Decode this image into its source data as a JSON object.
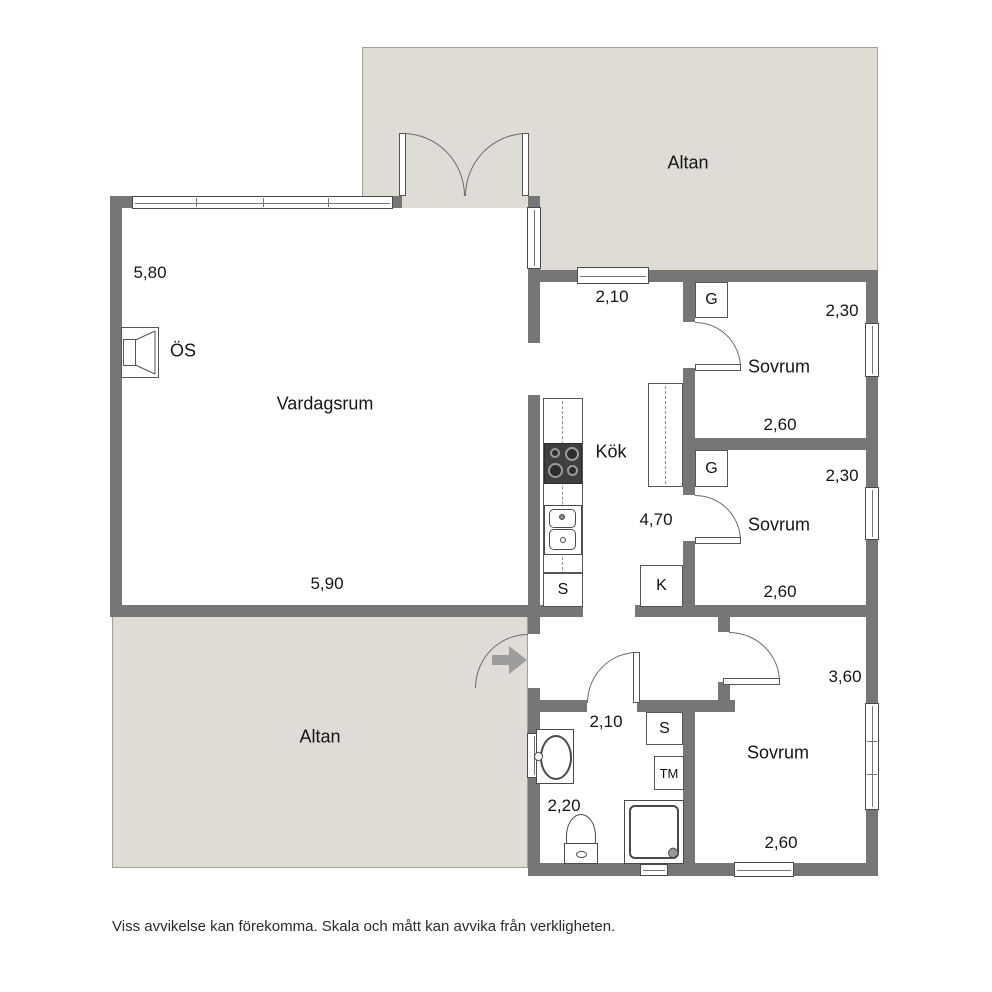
{
  "meta": {
    "type": "floor-plan"
  },
  "colors": {
    "wall": "#767676",
    "terrace_fill": "#dfdcd5",
    "fixture_line": "#4a4a4a",
    "entry_arrow": "#9c9c9c"
  },
  "rooms": {
    "altan_top": {
      "label": "Altan"
    },
    "altan_bottom": {
      "label": "Altan"
    },
    "vardagsrum": {
      "label": "Vardagsrum",
      "dim_height": "5,80",
      "dim_width": "5,90",
      "fireplace": "ÖS"
    },
    "kok": {
      "label": "Kök",
      "window_dim": "2,10",
      "dim_length": "4,70",
      "cabinet": "S",
      "fridge": "K"
    },
    "sovrum1": {
      "label": "Sovrum",
      "dim_height": "2,30",
      "dim_width": "2,60",
      "wardrobe": "G"
    },
    "sovrum2": {
      "label": "Sovrum",
      "dim_height": "2,30",
      "dim_width": "2,60",
      "wardrobe": "G"
    },
    "sovrum3": {
      "label": "Sovrum",
      "dim_height": "3,60",
      "dim_width": "2,60"
    },
    "badrum": {
      "dim_width": "2,10",
      "dim_height": "2,20",
      "closet": "S",
      "washing_machine": "TM"
    }
  },
  "footer": {
    "disclaimer": "Viss avvikelse kan förekomma. Skala och mått kan avvika från verkligheten."
  }
}
